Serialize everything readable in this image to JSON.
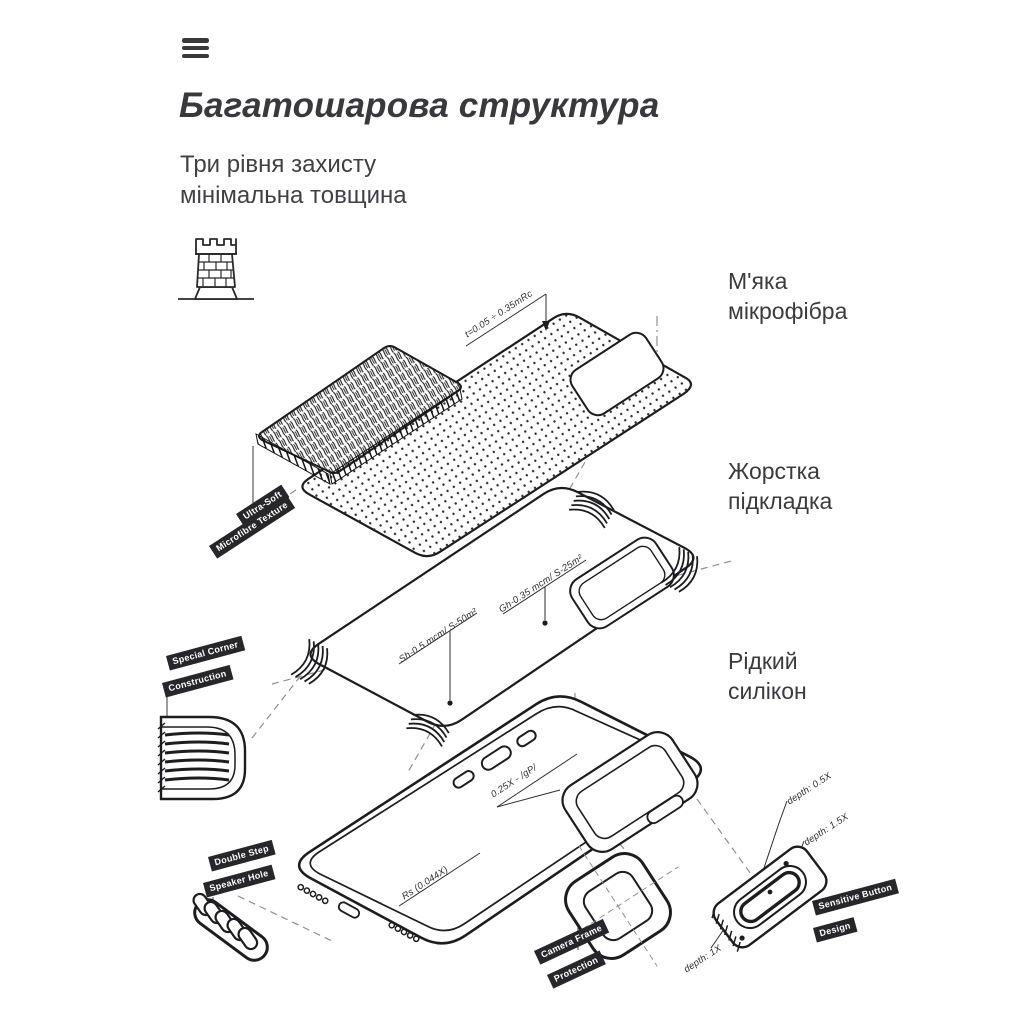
{
  "colors": {
    "ink": "#1d1d1f",
    "heading": "#39393c",
    "body_text": "#3b3b3e",
    "tag_bg": "#27272a",
    "tag_text": "#ffffff",
    "dash_line": "#8f8f93"
  },
  "nav": {
    "menu_icon": "hamburger-menu"
  },
  "header": {
    "title": "Багатошарова структура",
    "subtitle": [
      "Три рівня захисту",
      "мінімальна товщина"
    ]
  },
  "callouts": {
    "microfiber": [
      "М'яка",
      "мікрофібра"
    ],
    "hard_liner": [
      "Жорстка",
      "підкладка"
    ],
    "silicone": [
      "Рідкий",
      "силікон"
    ]
  },
  "tags": {
    "ultra_soft": [
      "Ultra-Soft",
      "Microfibre Texture"
    ],
    "special_corner": [
      "Special Corner",
      "Construction"
    ],
    "double_step": [
      "Double Step",
      "Speaker Hole"
    ],
    "camera_frame": [
      "Camera Frame",
      "Protection"
    ],
    "sensitive_button": [
      "Sensitive Button",
      "Design"
    ]
  },
  "dimensions": {
    "microfiber_thickness": "t=0.05 ÷ 0.35mRc",
    "texture_top": "Gh-0.35 mcm/ S-25m²",
    "texture_bottom": "Sh-0.5 mcm/ S-50m²",
    "button_offset": "0.25X - /gP/",
    "corner_radius": "Rs (0.044X)",
    "depth_a": "depth: 0.5X",
    "depth_b": "depth: 1.5X",
    "depth_c": "depth: 1X"
  },
  "icons": {
    "tower": "fortress-tower-icon"
  }
}
